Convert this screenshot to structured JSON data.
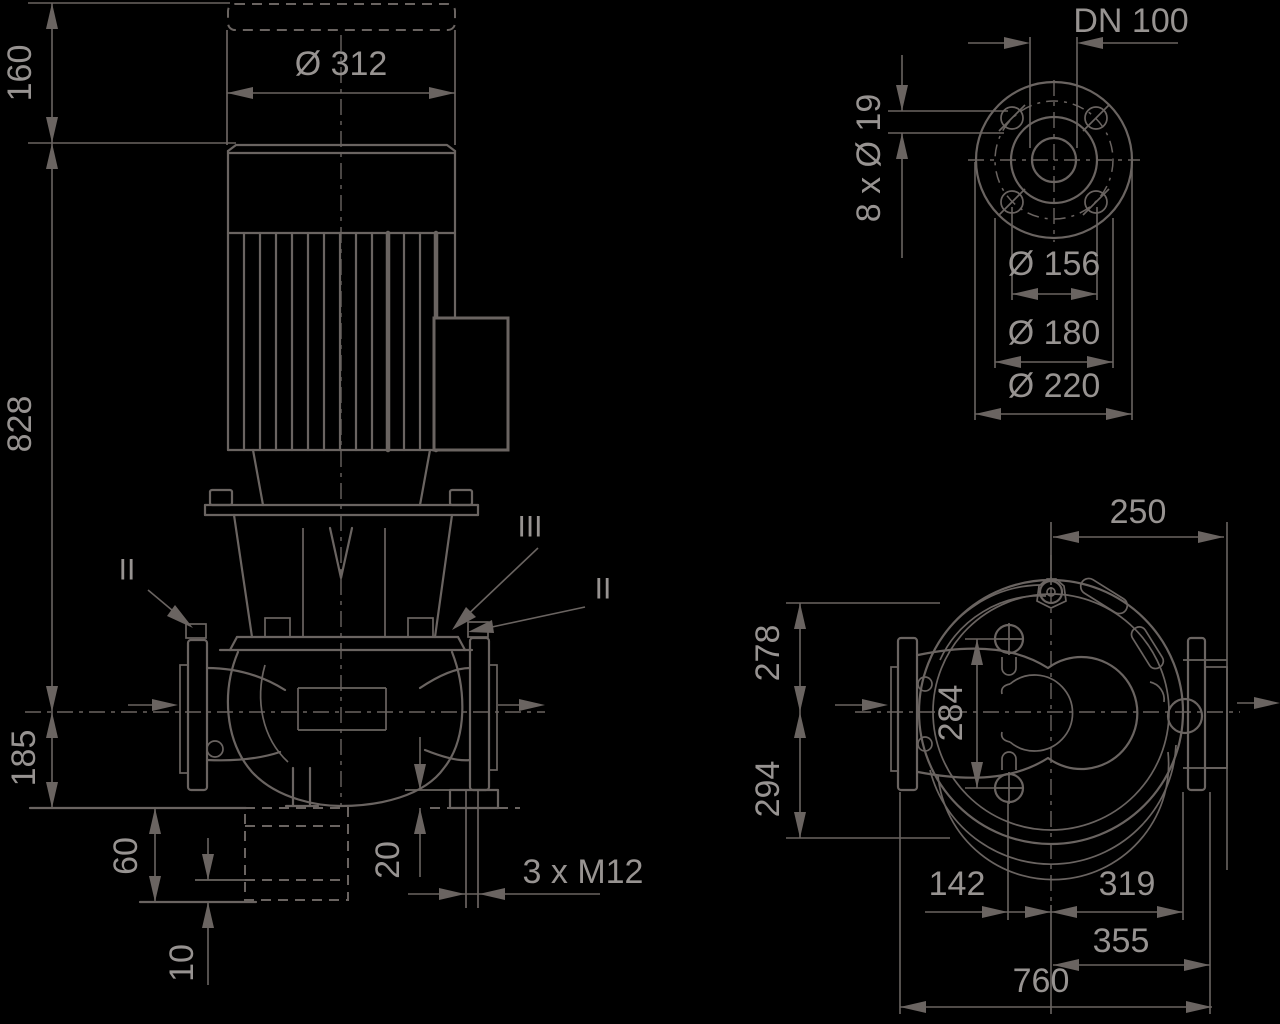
{
  "front_view": {
    "dim_160": "160",
    "dim_828": "828",
    "dim_185": "185",
    "dim_60": "60",
    "dim_10": "10",
    "dim_20": "20",
    "dim_motor_diameter": "Ø 312",
    "bolt_callout": "3 x M12",
    "section_label_left": "II",
    "section_label_mid": "III",
    "section_label_right": "II"
  },
  "flange_view": {
    "nominal_diameter": "DN 100",
    "bolt_holes": "8 x Ø 19",
    "raised_face_diameter": "Ø 156",
    "bolt_circle_diameter": "Ø 180",
    "flange_outer_diameter": "Ø 220"
  },
  "plan_view": {
    "dim_250": "250",
    "dim_278": "278",
    "dim_294": "294",
    "dim_284": "284",
    "dim_142": "142",
    "dim_319": "319",
    "dim_355": "355",
    "dim_760": "760"
  },
  "colors": {
    "background": "#000000",
    "line": "#6a6461",
    "text": "#979391"
  }
}
